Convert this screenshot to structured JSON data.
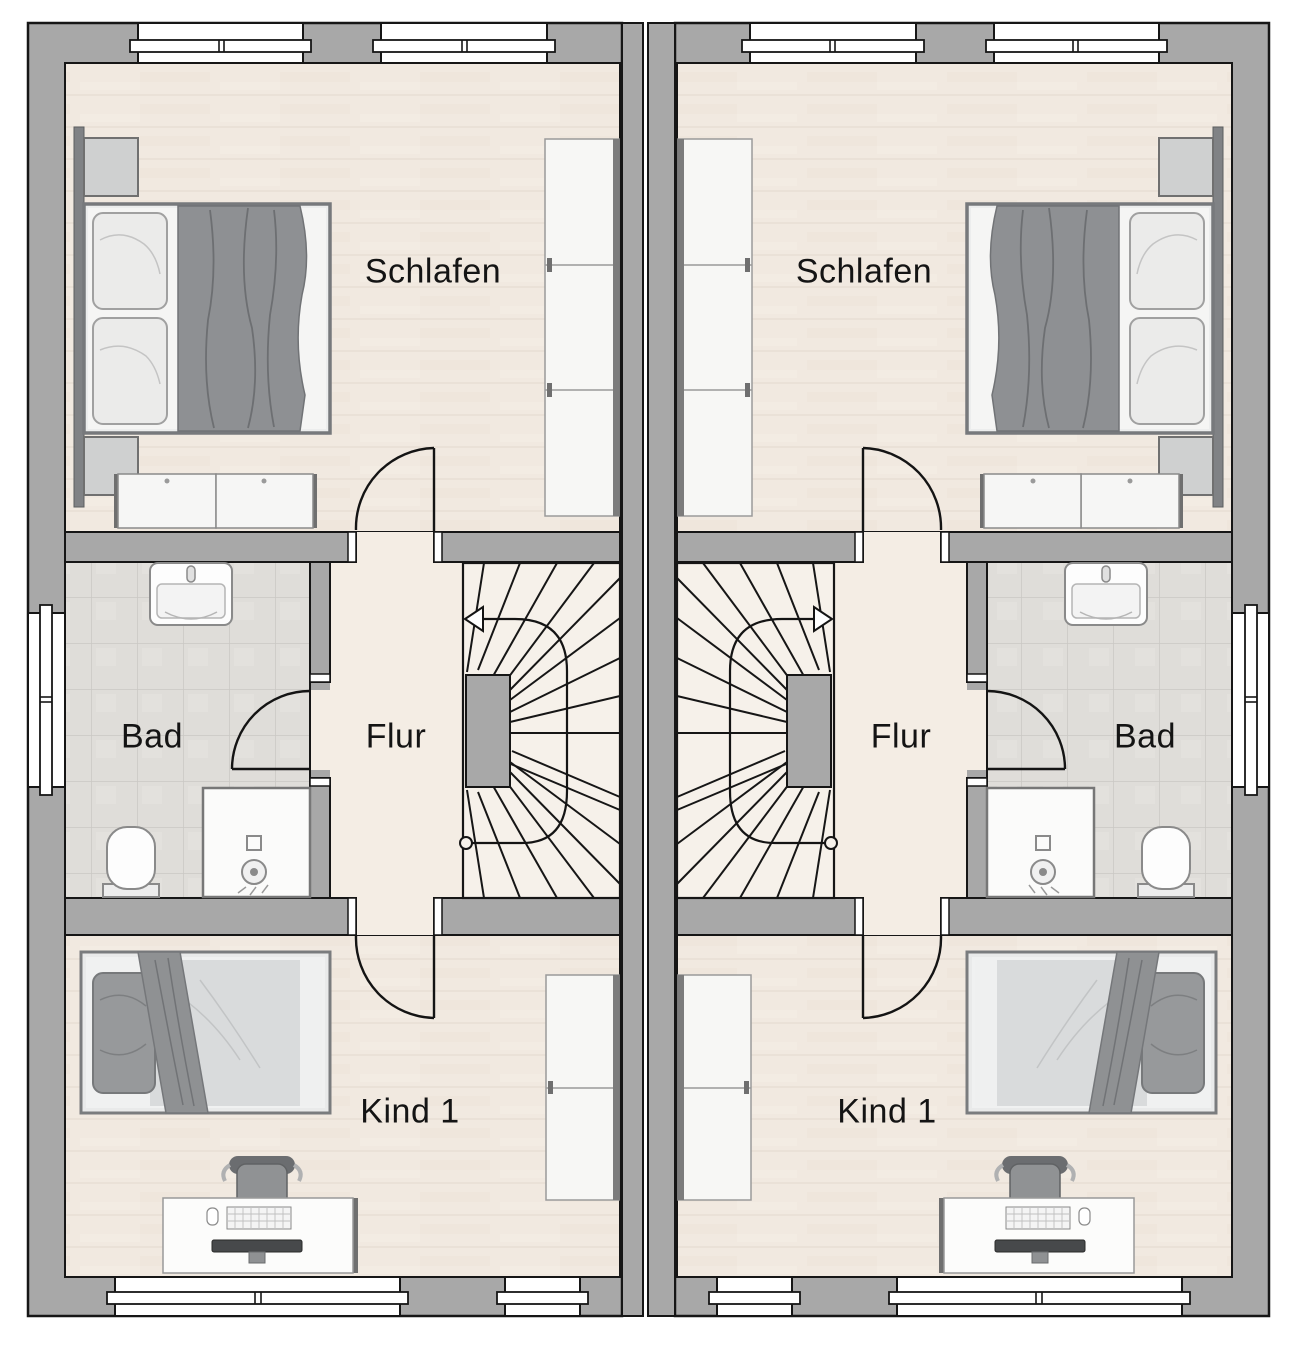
{
  "plan": {
    "kind": "floor-plan",
    "colors": {
      "wall": "#a8a8a8",
      "outline": "#161616",
      "bedroom_floor": "#f1e9e0",
      "bath_floor": "#dfddd9",
      "hall_floor": "#f4ede4",
      "stair_floor": "#f6f1ea",
      "furniture_white": "#f7f7f5",
      "textile_gray": "#8f9193"
    }
  },
  "units": [
    {
      "id": "left",
      "labels": {
        "bedroom": "Schlafen",
        "bath": "Bad",
        "hall": "Flur",
        "child": "Kind 1"
      }
    },
    {
      "id": "right",
      "labels": {
        "bedroom": "Schlafen",
        "bath": "Bad",
        "hall": "Flur",
        "child": "Kind 1"
      }
    }
  ]
}
